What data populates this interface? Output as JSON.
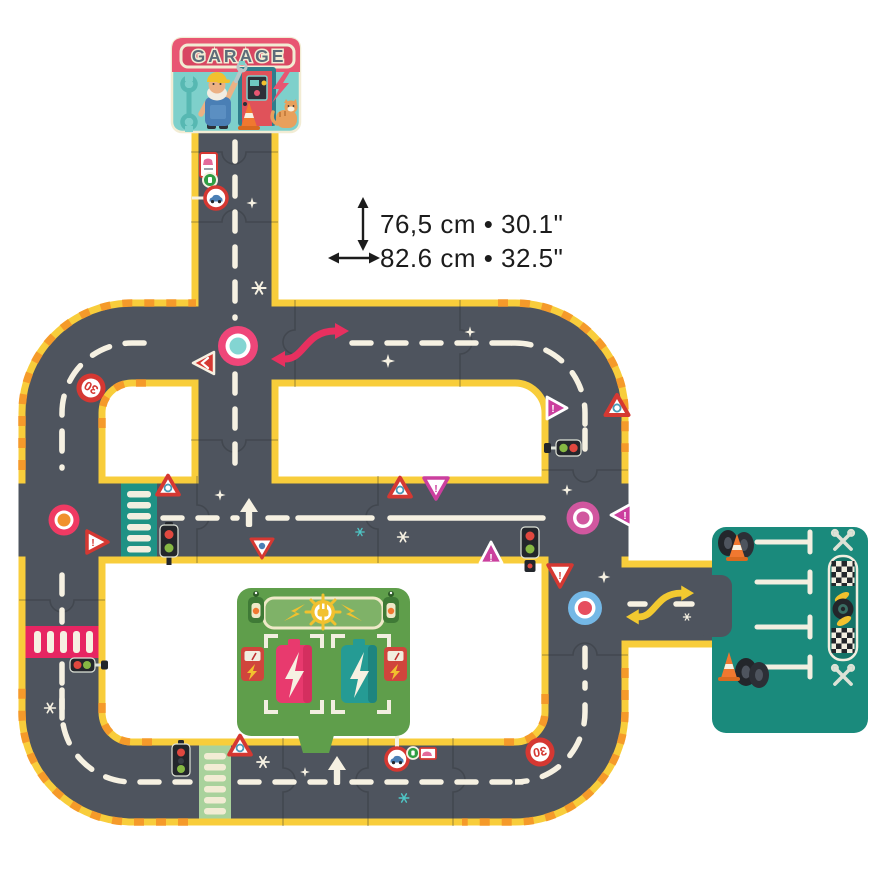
{
  "annotations": {
    "height_label": "76,5 cm • 30.1\"",
    "width_label": "82.6 cm • 32.5\""
  },
  "garage": {
    "sign_text": "GARAGE"
  },
  "signs": {
    "speed_limit_top_left": "30",
    "speed_limit_bottom_right": "30",
    "exclamation": "!"
  },
  "palette": {
    "road": "#4e545e",
    "edge_yellow": "#f8cd3b",
    "stripe_orange": "#f59a2a",
    "marking_white": "#f6f1e2",
    "station_green": "#5f9e4b",
    "parking_teal": "#1a8a7c",
    "garage_pink": "#e85672",
    "garage_teal": "#7ed0cb"
  }
}
